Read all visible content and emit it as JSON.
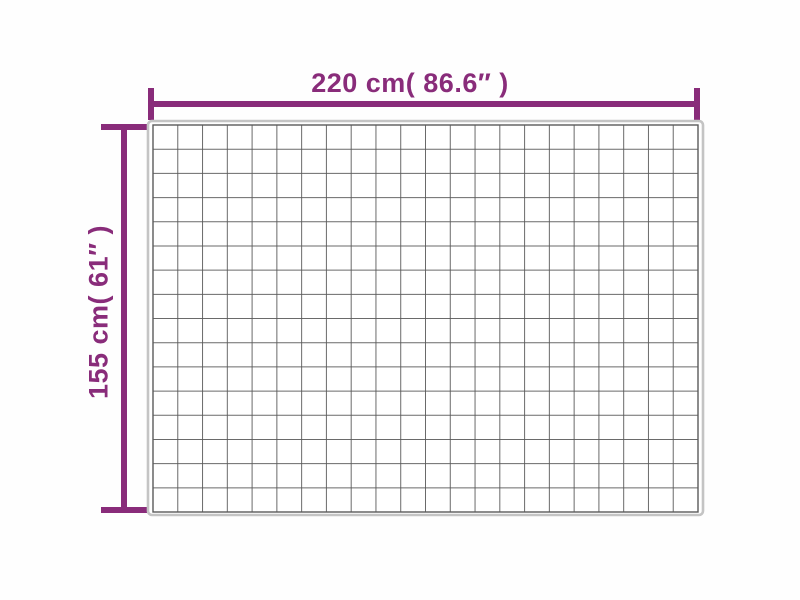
{
  "page": {
    "background": "#fefefe"
  },
  "diagram": {
    "accent_color": "#892C7A",
    "width_label": "220 cm( 86.6″ )",
    "height_label": "155 cm( 61″ )",
    "measurements": {
      "width_cm": 220,
      "width_inches": 86.6,
      "height_cm": 155,
      "height_inches": 61
    },
    "blanket": {
      "grid_columns": 22,
      "grid_rows": 16,
      "grid_line_color": "#5a5a5a",
      "edge_color": "#c4c4c4",
      "fill": "#ffffff"
    }
  }
}
